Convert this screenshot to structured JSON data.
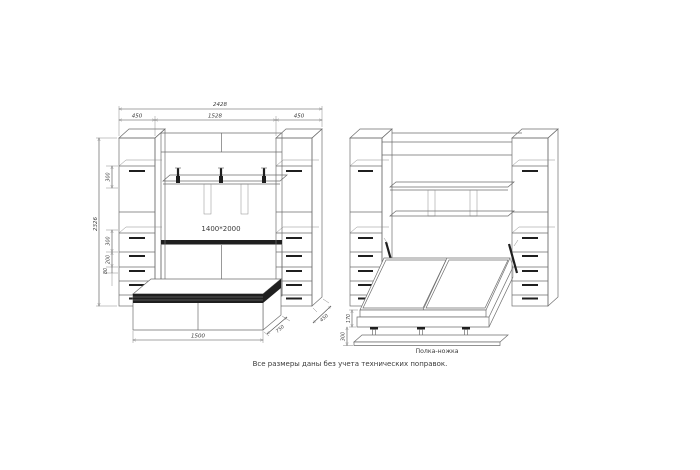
{
  "page": {
    "title": "wall-bed cabinet technical drawing",
    "note": "Все размеры даны без учета технических поправок.",
    "colors": {
      "background": "#ffffff",
      "line": "#6e6e6e",
      "dark": "#1f1f1f",
      "text": "#3a3a3a"
    }
  },
  "left_drawing": {
    "description": "closed wall-bed with side columns and bench",
    "dims": {
      "total_width": "2428",
      "left_column_width": "450",
      "center_width": "1528",
      "right_column_width": "450",
      "total_height": "2326",
      "upper_gap": "300",
      "middle_gap": "300",
      "drawer_gap": "200",
      "plinth": "80",
      "bed_size_label": "1400*2000",
      "bench_width": "1500",
      "bench_depth": "750",
      "column_depth": "450"
    }
  },
  "right_drawing": {
    "description": "open wall-bed with mattress, gas lifts and leg shelf",
    "dims": {
      "platform_height": "170",
      "base_height": "300"
    },
    "leg_shelf_label": "Полка-ножка"
  }
}
